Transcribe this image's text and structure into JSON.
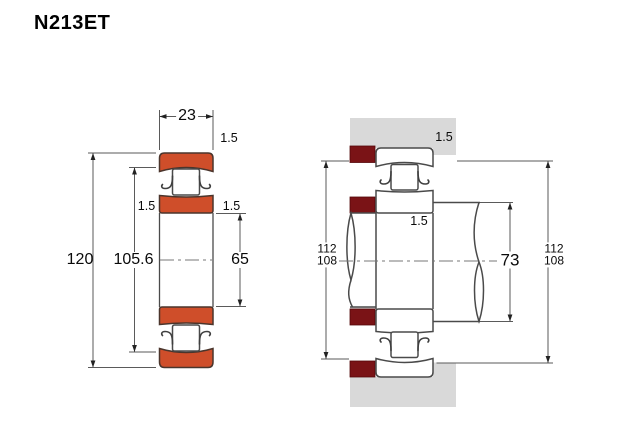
{
  "title": "N213ET",
  "colors": {
    "ring_orange": "#cf4e2a",
    "locating_ring_maroon": "#7a1316",
    "housing_gray": "#d9d9d9",
    "outline": "#4a4a4a",
    "dimension_line": "#5a5a5a"
  },
  "left_view": {
    "description": "bearing cross-section",
    "dims": {
      "width": "23",
      "outer_diameter": "120",
      "raceway_diameter": "105.6",
      "bore_diameter": "65",
      "chamfer_top": "1.5",
      "chamfer_left": "1.5",
      "chamfer_right": "1.5"
    }
  },
  "right_view": {
    "description": "mounted bearing section with shaft and housing",
    "dims": {
      "housing_chamfer": "1.5",
      "inner_ring_chamfer": "1.5",
      "abutment_left_top": "112",
      "abutment_left_bottom": "108",
      "shaft_shoulder": "73",
      "abutment_right_top": "112",
      "abutment_right_bottom": "108"
    }
  }
}
